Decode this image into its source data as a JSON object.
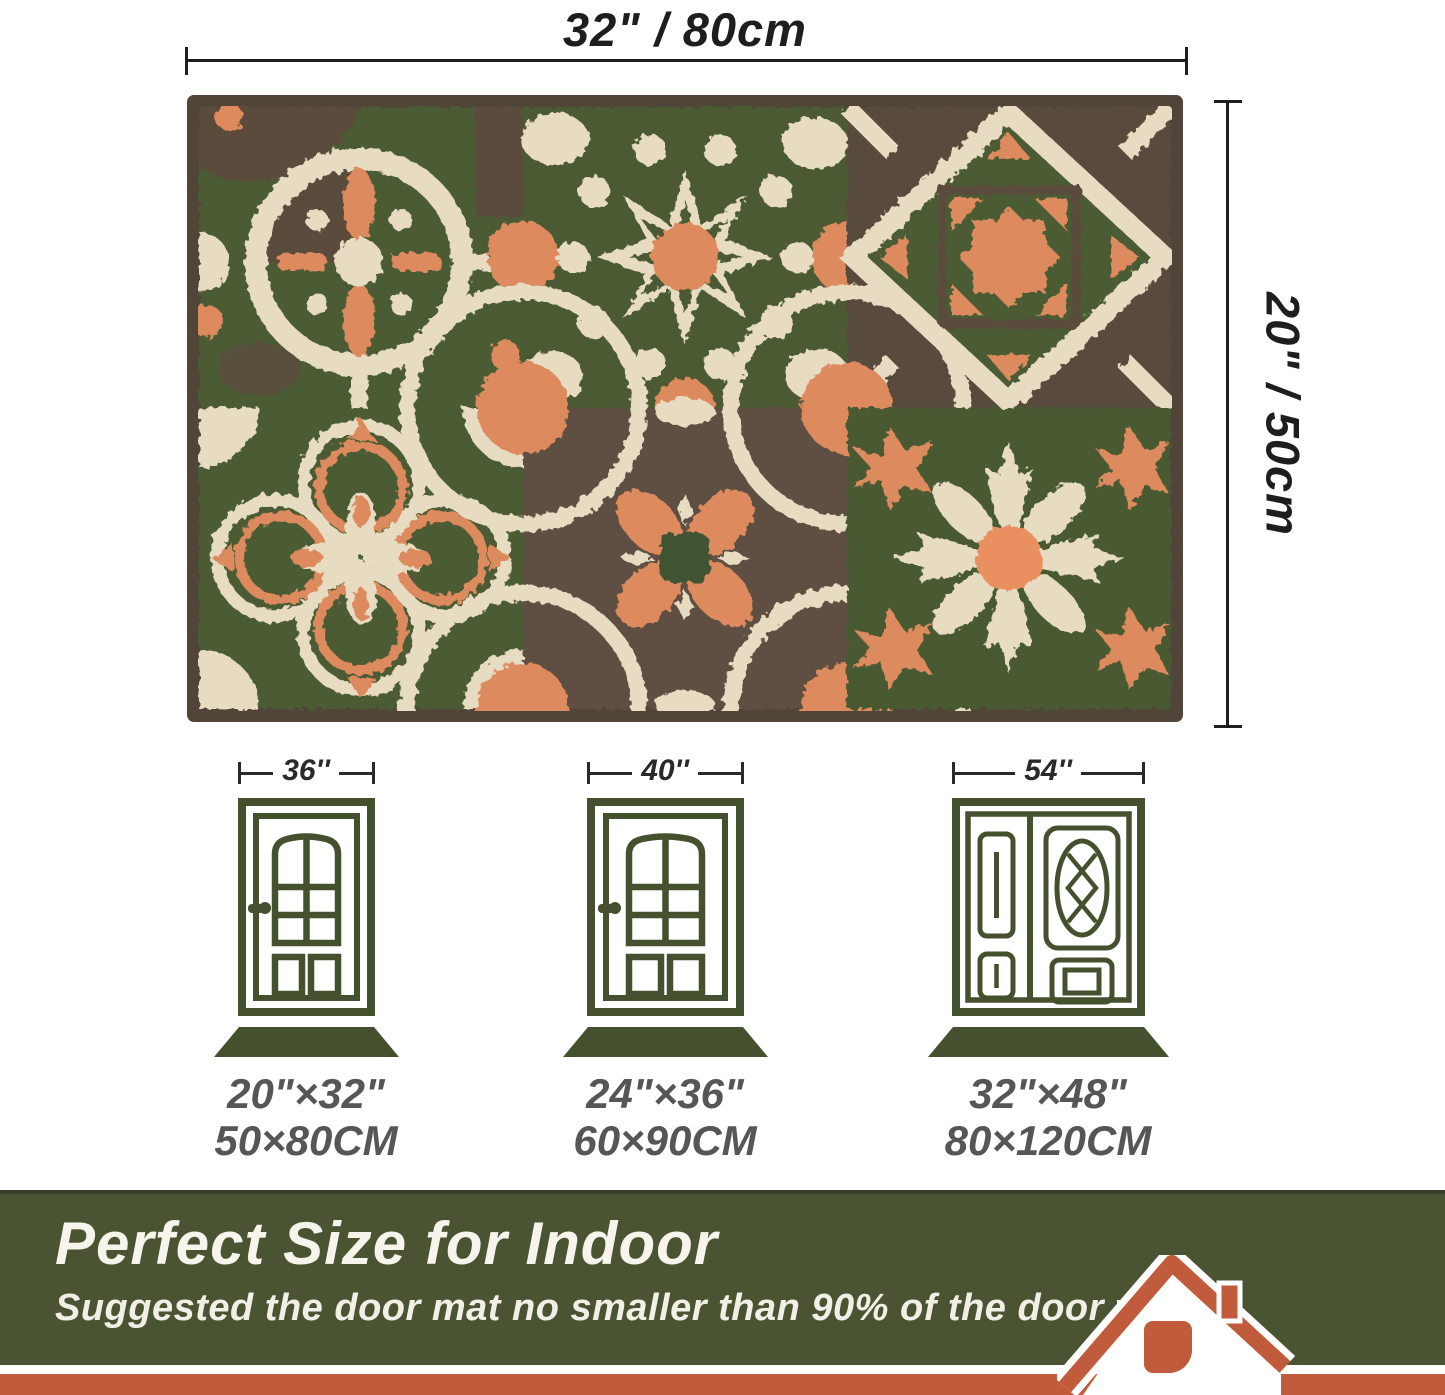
{
  "rug": {
    "width_label": "32\" / 80cm",
    "height_label": "20\" / 50cm"
  },
  "doors": [
    {
      "type": "single",
      "width_label": "36''",
      "mat_inches": "20\"×32\"",
      "mat_cm": "50×80CM"
    },
    {
      "type": "single",
      "width_label": "40''",
      "mat_inches": "24\"×36\"",
      "mat_cm": "60×90CM"
    },
    {
      "type": "double",
      "width_label": "54''",
      "mat_inches": "32\"×48\"",
      "mat_cm": "80×120CM"
    }
  ],
  "banner": {
    "title": "Perfect Size for Indoor",
    "subtitle": "Suggested the door mat no smaller than 90% of the door width."
  },
  "colors": {
    "banner_green": "#4A5433",
    "banner_green_dark_edge": "#37422A",
    "bottom_strip_orange": "#C05C3B",
    "house_terracotta": "#C05C3B",
    "door_icon_green": "#45512E",
    "mat_icon_green": "#45512E",
    "rug_green": "#4C5C35",
    "rug_orange": "#DD8A5E",
    "rug_cream": "#E7DCC2",
    "rug_brown": "#5A4C3D",
    "rug_border_brown": "#51453A",
    "dimension_text": "#1E1E1E",
    "size_text_gray": "#565656"
  }
}
